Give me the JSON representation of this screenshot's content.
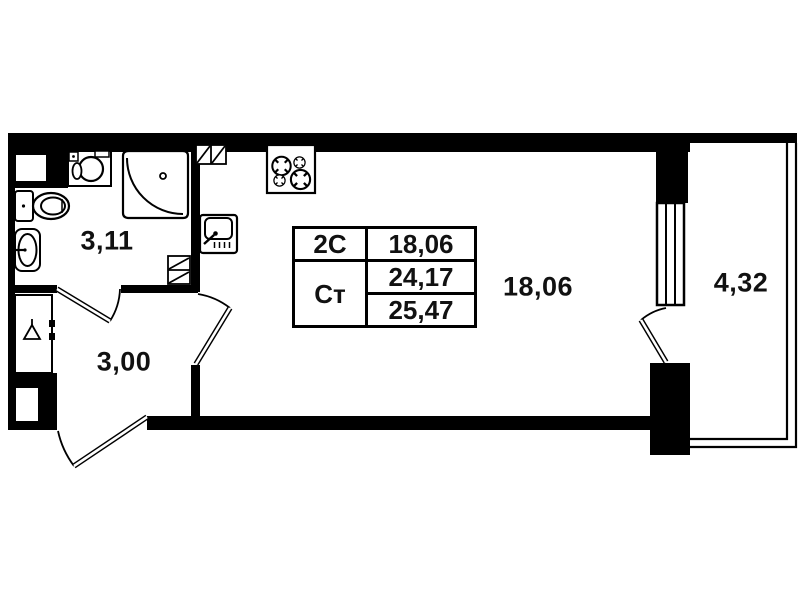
{
  "plan_type": "studio-apartment-floor-plan",
  "colors": {
    "wall": "#000000",
    "background": "#ffffff",
    "line": "#000000"
  },
  "rooms": [
    {
      "name": "bathroom",
      "area": "3,11"
    },
    {
      "name": "hallway",
      "area": "3,00"
    },
    {
      "name": "living-kitchen",
      "area": "18,06"
    },
    {
      "name": "balcony",
      "area": "4,32"
    }
  ],
  "area_table": {
    "row_type": {
      "label": "2С",
      "value": "18,06"
    },
    "row_studio": {
      "label": "Ст",
      "living_area": "24,17",
      "total_area": "25,47"
    }
  },
  "fixtures": [
    "washbasin-cabinet-icon",
    "corner-shower-icon",
    "toilet-icon",
    "oval-sink-icon",
    "vent-shaft-icon",
    "vent-shaft-icon",
    "kitchen-sink-icon",
    "stove-4-burner-icon",
    "wardrobe-hanger-icon",
    "window-icon",
    "balcony-glazing-icon",
    "door-swing-icon",
    "door-swing-icon",
    "door-swing-icon",
    "door-swing-icon"
  ]
}
